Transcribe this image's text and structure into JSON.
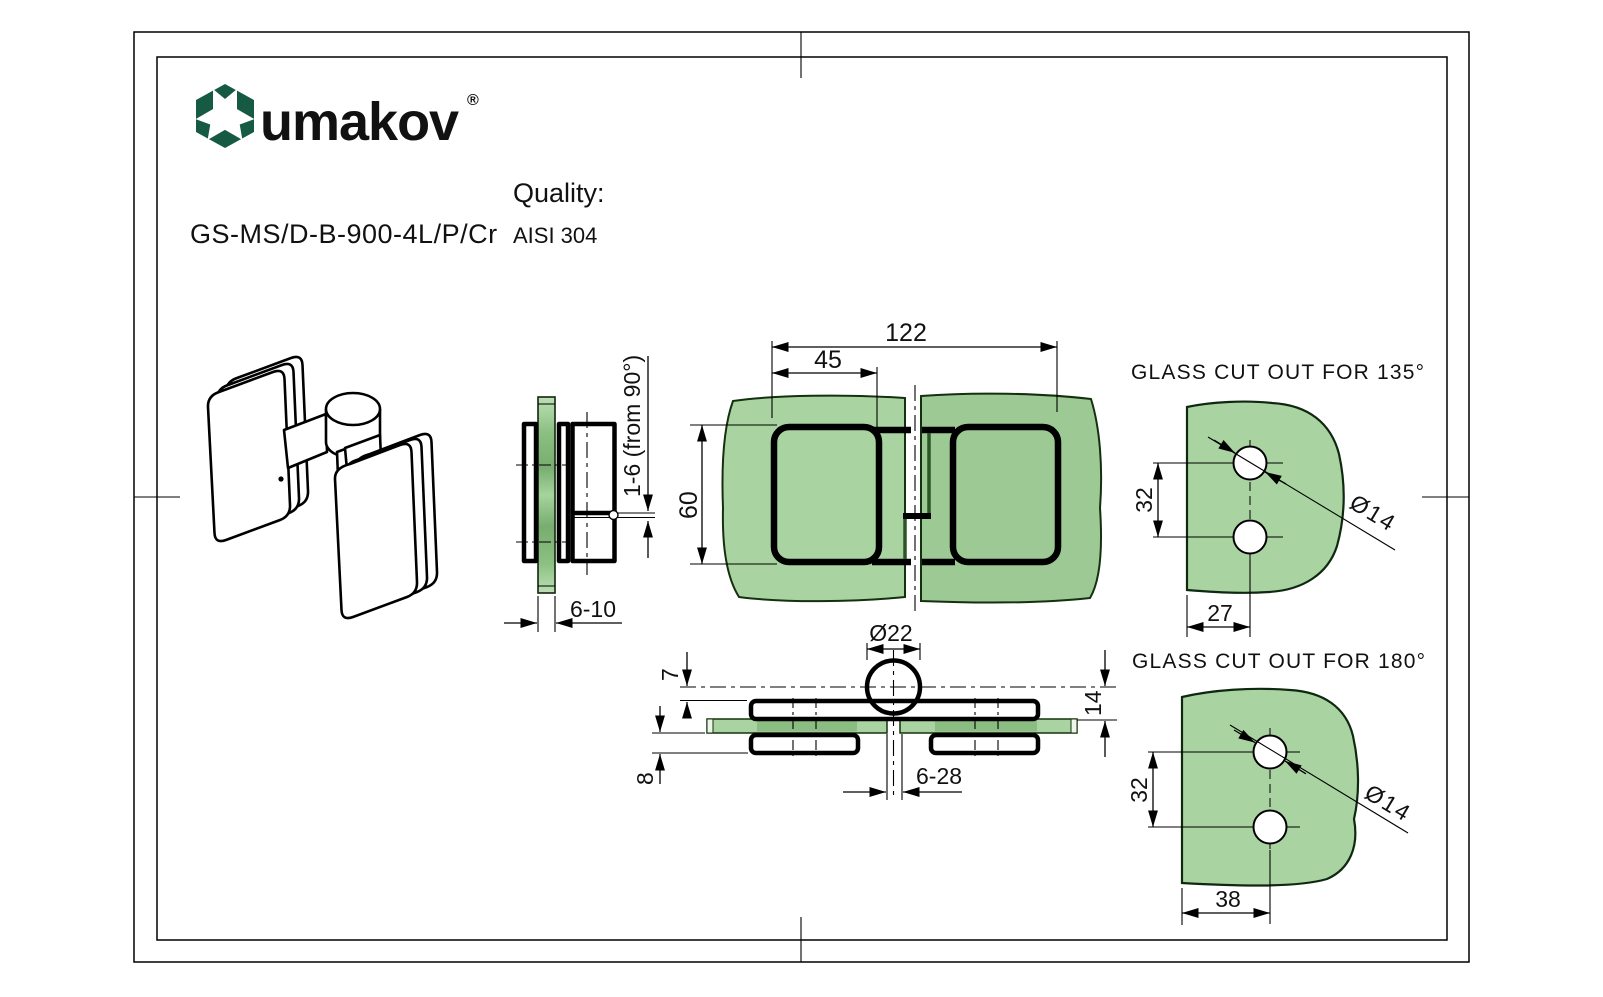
{
  "logo": {
    "brand": "umakov",
    "registered": "®"
  },
  "header": {
    "product_code": "GS-MS/D-B-900-4L/P/Cr",
    "quality_label": "Quality:",
    "quality_value": "AISI 304"
  },
  "side_view": {
    "adjust_dim": "1-6 (from 90°)",
    "glass_thickness_dim": "6-10"
  },
  "front_view": {
    "overall_width_dim": "122",
    "plate_width_dim": "45",
    "height_dim": "60"
  },
  "bottom_view": {
    "knuckle_dim": "Ø22",
    "offset_top_dim": "7",
    "offset_bottom_dim": "8",
    "axis_dim": "14",
    "gap_dim": "6-28"
  },
  "cutout_135": {
    "title": "GLASS CUT OUT FOR 135°",
    "hole_spacing_dim": "32",
    "edge_dim": "27",
    "hole_dia_dim": "Ø14"
  },
  "cutout_180": {
    "title": "GLASS CUT OUT FOR 180°",
    "hole_spacing_dim": "32",
    "edge_dim": "38",
    "hole_dia_dim": "Ø14"
  },
  "colors": {
    "glass": "#a9d4a1",
    "glass_shaded": "#9cc994",
    "glass_dark": "#8bbc82",
    "logo_green": "#175a43",
    "line": "#000000"
  }
}
